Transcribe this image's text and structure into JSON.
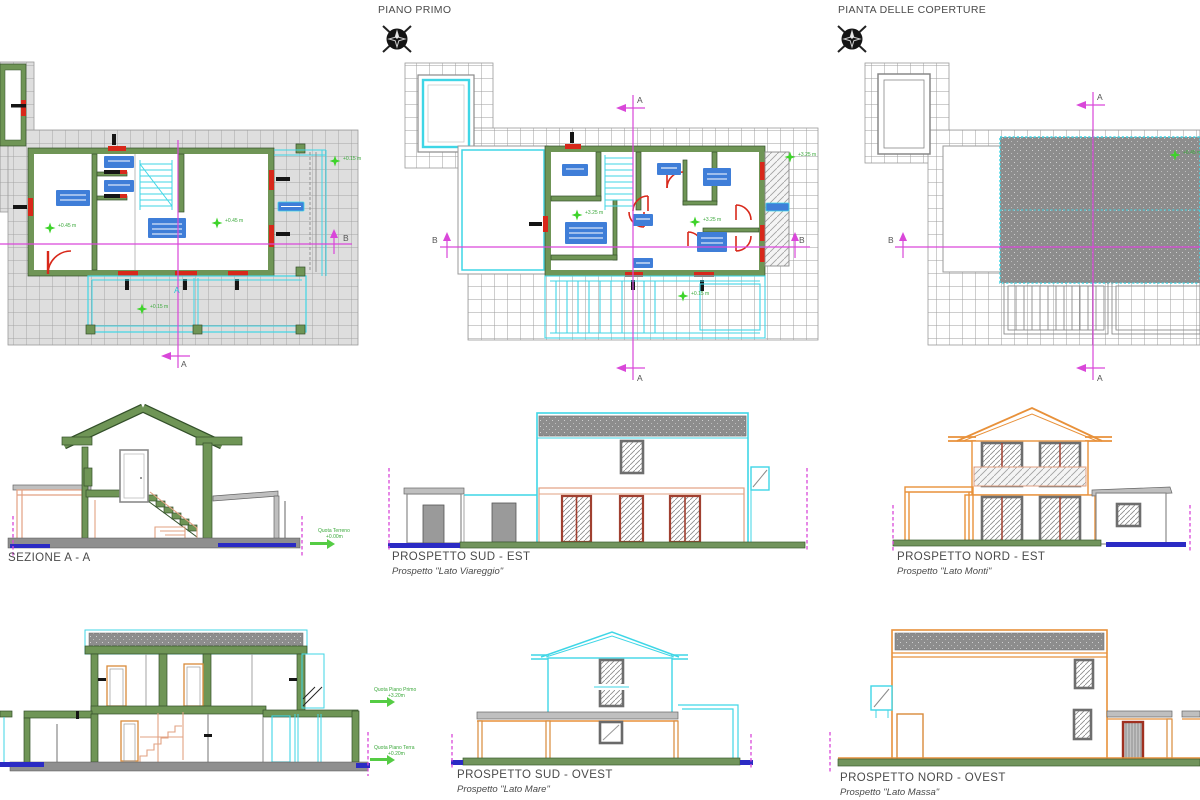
{
  "sheet": {
    "type": "architectural-drawing",
    "background": "#ffffff"
  },
  "drawings": {
    "piano_primo": {
      "title": "PIANO PRIMO"
    },
    "coperture": {
      "title": "PIANTA DELLE COPERTURE"
    },
    "sezione_aa": {
      "title": "SEZIONE  A - A"
    },
    "sud_est": {
      "title": "PROSPETTO SUD - EST",
      "subtitle": "Prospetto \"Lato Viareggio\""
    },
    "nord_est": {
      "title": "PROSPETTO NORD - EST",
      "subtitle": "Prospetto \"Lato Monti\""
    },
    "sud_ovest": {
      "title": "PROSPETTO SUD - OVEST",
      "subtitle": "Prospetto \"Lato Mare\""
    },
    "nord_ovest": {
      "title": "PROSPETTO NORD - OVEST",
      "subtitle": "Prospetto \"Lato Massa\""
    }
  },
  "markers": {
    "section_a": "A",
    "section_b": "B"
  },
  "annotations": {
    "quota_terreno": {
      "label": "Quota Terreno",
      "value": "+0.00m"
    },
    "quota_piano_primo": {
      "label": "Quota Piano Primo",
      "value": "+3.20m"
    },
    "quota_piano_terra": {
      "label": "Quota Piano Terra",
      "value": "+0.20m"
    },
    "levels": {
      "ground": "+0.45 m",
      "first": "+3.25 m",
      "roof": "+6.45 m",
      "terrace": "+0.15 m"
    }
  },
  "colors": {
    "wall_green": "#6f9556",
    "cad_red": "#d8281a",
    "cyan": "#3fd6e6",
    "magenta": "#d947d9",
    "orange": "#e8913a",
    "salmon": "#e2a182",
    "label_blue": "#3f7ed8",
    "ground_blue": "#2b2bc4",
    "roof_gray": "#8d8d8d",
    "star_green": "#3ed32a",
    "ground_green": "#71945c"
  }
}
